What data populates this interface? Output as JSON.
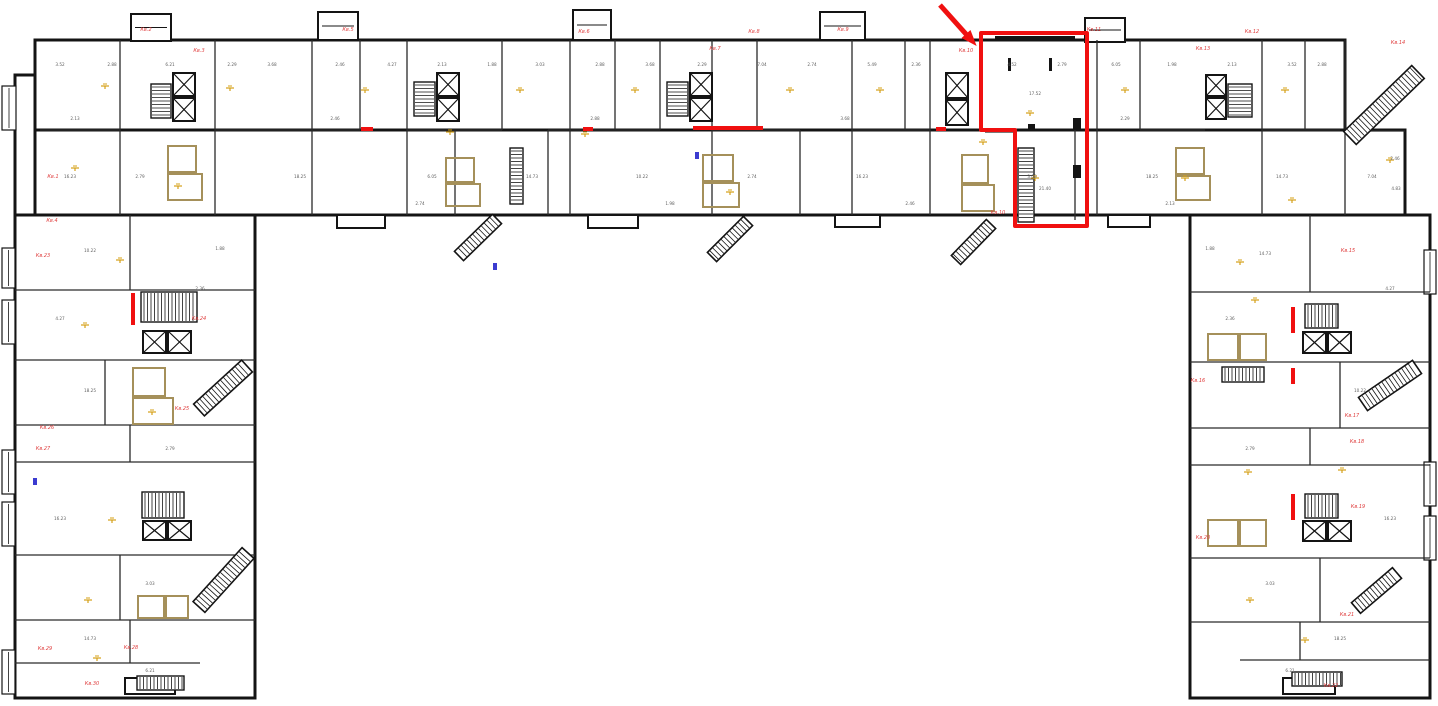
{
  "meta": {
    "drawing_type": "apartment-building-floor-plan",
    "canvas": {
      "w": 1438,
      "h": 706
    },
    "colors": {
      "wall": "#141414",
      "partition": "#2a2a2a",
      "wet_wall": "#a5905a",
      "light_symbol": "#d4a017",
      "dimension_text": "#5f5f5f",
      "apartment_label": "#e04040",
      "highlight": "#f01010",
      "blue_mark": "#3b3bd0",
      "background": "#ffffff"
    }
  },
  "plan": {
    "outer": [
      [
        15,
        75,
        105,
        140
      ],
      [
        35,
        40,
        1310,
        95
      ],
      [
        35,
        130,
        1370,
        85
      ],
      [
        15,
        215,
        240,
        483
      ],
      [
        1190,
        215,
        240,
        483
      ]
    ],
    "towers": [
      [
        131,
        14,
        40,
        27
      ],
      [
        318,
        12,
        40,
        28
      ],
      [
        573,
        10,
        38,
        30
      ],
      [
        820,
        12,
        45,
        28
      ],
      [
        1085,
        18,
        40,
        24
      ]
    ],
    "edge_balconies": [
      [
        2,
        86,
        14,
        44
      ],
      [
        2,
        248,
        13,
        40
      ],
      [
        2,
        300,
        13,
        44
      ],
      [
        2,
        450,
        13,
        44
      ],
      [
        2,
        502,
        13,
        44
      ],
      [
        2,
        650,
        13,
        44
      ],
      [
        1424,
        250,
        12,
        44
      ],
      [
        1424,
        462,
        12,
        44
      ],
      [
        1424,
        516,
        12,
        44
      ]
    ],
    "elevators": [
      [
        173,
        73,
        22,
        23
      ],
      [
        173,
        98,
        22,
        23
      ],
      [
        437,
        73,
        22,
        23
      ],
      [
        437,
        98,
        22,
        23
      ],
      [
        690,
        73,
        22,
        23
      ],
      [
        690,
        98,
        22,
        23
      ],
      [
        946,
        73,
        22,
        25
      ],
      [
        946,
        100,
        22,
        25
      ],
      [
        1206,
        75,
        20,
        21
      ],
      [
        1206,
        98,
        20,
        21
      ],
      [
        143,
        331,
        23,
        22
      ],
      [
        168,
        331,
        23,
        22
      ],
      [
        143,
        521,
        23,
        19
      ],
      [
        168,
        521,
        23,
        19
      ],
      [
        1303,
        332,
        23,
        21
      ],
      [
        1328,
        332,
        23,
        21
      ],
      [
        1303,
        521,
        23,
        20
      ],
      [
        1328,
        521,
        23,
        20
      ]
    ],
    "stairs": [
      [
        151,
        84,
        20,
        34,
        "h"
      ],
      [
        414,
        82,
        21,
        34,
        "h"
      ],
      [
        667,
        82,
        21,
        34,
        "h"
      ],
      [
        1018,
        148,
        16,
        74,
        "h"
      ],
      [
        1228,
        84,
        24,
        33,
        "h"
      ],
      [
        510,
        148,
        13,
        56,
        "h"
      ],
      [
        141,
        292,
        56,
        30,
        "v"
      ],
      [
        142,
        492,
        42,
        26,
        "v"
      ],
      [
        1305,
        304,
        33,
        24,
        "v"
      ],
      [
        1222,
        367,
        42,
        15,
        "v"
      ],
      [
        1305,
        494,
        33,
        24,
        "v"
      ],
      [
        137,
        676,
        47,
        14,
        "v"
      ],
      [
        1292,
        672,
        50,
        14,
        "v"
      ]
    ],
    "diag_balconies": [
      [
        1350,
        138,
        1418,
        72,
        18
      ],
      [
        199,
        410,
        247,
        366,
        16
      ],
      [
        199,
        607,
        248,
        553,
        16
      ],
      [
        1363,
        404,
        1417,
        367,
        16
      ],
      [
        1356,
        608,
        1397,
        573,
        14
      ],
      [
        497,
        219,
        459,
        256,
        13
      ],
      [
        748,
        221,
        712,
        257,
        13
      ],
      [
        991,
        224,
        956,
        260,
        13
      ]
    ],
    "bay_bumps": [
      [
        337,
        215,
        48,
        13
      ],
      [
        588,
        215,
        50,
        13
      ],
      [
        835,
        215,
        45,
        12
      ],
      [
        1108,
        215,
        42,
        12
      ],
      [
        125,
        678,
        50,
        16
      ],
      [
        1283,
        678,
        52,
        16
      ]
    ],
    "part_v": [
      [
        120,
        40,
        215
      ],
      [
        215,
        40,
        215
      ],
      [
        312,
        40,
        215
      ],
      [
        360,
        40,
        130
      ],
      [
        407,
        40,
        215
      ],
      [
        455,
        130,
        215
      ],
      [
        502,
        40,
        130
      ],
      [
        548,
        130,
        215
      ],
      [
        570,
        40,
        215
      ],
      [
        615,
        40,
        130
      ],
      [
        660,
        40,
        130
      ],
      [
        712,
        40,
        215
      ],
      [
        757,
        40,
        130
      ],
      [
        800,
        130,
        215
      ],
      [
        852,
        40,
        215
      ],
      [
        905,
        40,
        130
      ],
      [
        930,
        40,
        215
      ],
      [
        1075,
        120,
        220
      ],
      [
        1097,
        40,
        215
      ],
      [
        1140,
        40,
        130
      ],
      [
        1262,
        40,
        215
      ],
      [
        1305,
        40,
        130
      ],
      [
        1345,
        40,
        215
      ],
      [
        130,
        215,
        290
      ],
      [
        105,
        360,
        425
      ],
      [
        130,
        425,
        462
      ],
      [
        120,
        555,
        620
      ],
      [
        130,
        620,
        663
      ],
      [
        1310,
        215,
        292
      ],
      [
        1340,
        362,
        428
      ],
      [
        1310,
        428,
        465
      ],
      [
        1320,
        558,
        622
      ],
      [
        1300,
        622,
        660
      ]
    ],
    "part_h": [
      [
        130,
        40,
        120
      ],
      [
        130,
        215,
        360
      ],
      [
        130,
        407,
        502
      ],
      [
        130,
        548,
        660
      ],
      [
        130,
        712,
        800
      ],
      [
        130,
        852,
        930
      ],
      [
        132,
        985,
        1015
      ],
      [
        130,
        1140,
        1205
      ],
      [
        130,
        1262,
        1340
      ],
      [
        131,
        1345,
        1405
      ],
      [
        290,
        15,
        255
      ],
      [
        360,
        15,
        255
      ],
      [
        425,
        15,
        255
      ],
      [
        462,
        15,
        255
      ],
      [
        555,
        15,
        255
      ],
      [
        620,
        15,
        255
      ],
      [
        663,
        15,
        200
      ],
      [
        292,
        1190,
        1430
      ],
      [
        362,
        1190,
        1430
      ],
      [
        428,
        1190,
        1430
      ],
      [
        465,
        1190,
        1430
      ],
      [
        558,
        1190,
        1430
      ],
      [
        622,
        1190,
        1430
      ],
      [
        660,
        1240,
        1430
      ]
    ],
    "wet_walls": [
      [
        168,
        146,
        28,
        26
      ],
      [
        168,
        174,
        34,
        26
      ],
      [
        446,
        158,
        28,
        24
      ],
      [
        446,
        184,
        34,
        22
      ],
      [
        703,
        155,
        30,
        26
      ],
      [
        703,
        183,
        36,
        24
      ],
      [
        962,
        155,
        26,
        28
      ],
      [
        962,
        185,
        32,
        26
      ],
      [
        1176,
        148,
        28,
        26
      ],
      [
        1176,
        176,
        34,
        24
      ],
      [
        133,
        368,
        32,
        28
      ],
      [
        133,
        398,
        40,
        26
      ],
      [
        138,
        596,
        26,
        22
      ],
      [
        166,
        596,
        22,
        22
      ],
      [
        1208,
        334,
        30,
        26
      ],
      [
        1240,
        334,
        26,
        26
      ],
      [
        1208,
        520,
        30,
        26
      ],
      [
        1240,
        520,
        26,
        26
      ]
    ],
    "red_walls": [
      [
        693,
        126,
        70,
        4
      ],
      [
        131,
        293,
        4,
        32
      ],
      [
        1291,
        307,
        4,
        26
      ],
      [
        1291,
        368,
        4,
        16
      ],
      [
        1291,
        494,
        4,
        26
      ],
      [
        361,
        127,
        12,
        4
      ],
      [
        936,
        127,
        10,
        4
      ],
      [
        583,
        127,
        10,
        4
      ]
    ],
    "unit_details": [
      [
        995,
        36,
        80,
        5
      ],
      [
        1008,
        58,
        3,
        13
      ],
      [
        1049,
        58,
        3,
        13
      ],
      [
        1028,
        124,
        7,
        7
      ],
      [
        1073,
        118,
        8,
        12
      ],
      [
        1073,
        165,
        8,
        13
      ]
    ],
    "lights": [
      [
        105,
        86
      ],
      [
        230,
        88
      ],
      [
        75,
        168
      ],
      [
        178,
        186
      ],
      [
        365,
        90
      ],
      [
        450,
        132
      ],
      [
        520,
        90
      ],
      [
        635,
        90
      ],
      [
        585,
        134
      ],
      [
        730,
        192
      ],
      [
        790,
        90
      ],
      [
        880,
        90
      ],
      [
        1030,
        113
      ],
      [
        983,
        142
      ],
      [
        1035,
        178
      ],
      [
        1125,
        90
      ],
      [
        1185,
        178
      ],
      [
        1285,
        90
      ],
      [
        1292,
        200
      ],
      [
        1390,
        160
      ],
      [
        120,
        260
      ],
      [
        85,
        325
      ],
      [
        152,
        412
      ],
      [
        112,
        520
      ],
      [
        88,
        600
      ],
      [
        97,
        658
      ],
      [
        1240,
        262
      ],
      [
        1255,
        300
      ],
      [
        1248,
        472
      ],
      [
        1342,
        470
      ],
      [
        1250,
        600
      ],
      [
        1305,
        640
      ]
    ],
    "blue_marks": [
      [
        695,
        152
      ],
      [
        33,
        478
      ],
      [
        493,
        263
      ]
    ],
    "dims": [
      [
        60,
        66,
        "3.52"
      ],
      [
        112,
        66,
        "2.88"
      ],
      [
        170,
        66,
        "6.21"
      ],
      [
        232,
        66,
        "2.29"
      ],
      [
        272,
        66,
        "3.68"
      ],
      [
        340,
        66,
        "2.46"
      ],
      [
        392,
        66,
        "4.27"
      ],
      [
        442,
        66,
        "2.13"
      ],
      [
        492,
        66,
        "1.88"
      ],
      [
        540,
        66,
        "3.03"
      ],
      [
        600,
        66,
        "2.88"
      ],
      [
        650,
        66,
        "3.68"
      ],
      [
        702,
        66,
        "2.29"
      ],
      [
        762,
        66,
        "7.04"
      ],
      [
        812,
        66,
        "2.74"
      ],
      [
        872,
        66,
        "5.49"
      ],
      [
        916,
        66,
        "2.36"
      ],
      [
        1012,
        66,
        "4.52"
      ],
      [
        1062,
        66,
        "2.79"
      ],
      [
        1116,
        66,
        "6.05"
      ],
      [
        1172,
        66,
        "1.98"
      ],
      [
        1232,
        66,
        "2.13"
      ],
      [
        1292,
        66,
        "3.52"
      ],
      [
        1322,
        66,
        "2.88"
      ],
      [
        70,
        178,
        "16.23"
      ],
      [
        140,
        178,
        "2.79"
      ],
      [
        300,
        178,
        "18.25"
      ],
      [
        432,
        178,
        "6.05"
      ],
      [
        532,
        178,
        "14.73"
      ],
      [
        642,
        178,
        "10.22"
      ],
      [
        752,
        178,
        "2.74"
      ],
      [
        862,
        178,
        "16.23"
      ],
      [
        1032,
        178,
        "3.03"
      ],
      [
        1152,
        178,
        "18.25"
      ],
      [
        1282,
        178,
        "14.73"
      ],
      [
        1372,
        178,
        "7.04"
      ],
      [
        1396,
        190,
        "4.83"
      ],
      [
        1395,
        160,
        "2.46"
      ],
      [
        75,
        120,
        "2.13"
      ],
      [
        335,
        120,
        "2.46"
      ],
      [
        595,
        120,
        "2.88"
      ],
      [
        845,
        120,
        "3.68"
      ],
      [
        1125,
        120,
        "2.29"
      ],
      [
        90,
        252,
        "10.22"
      ],
      [
        220,
        250,
        "1.88"
      ],
      [
        60,
        320,
        "4.27"
      ],
      [
        200,
        290,
        "2.36"
      ],
      [
        90,
        392,
        "18.25"
      ],
      [
        170,
        450,
        "2.79"
      ],
      [
        60,
        520,
        "16.23"
      ],
      [
        150,
        585,
        "3.03"
      ],
      [
        90,
        640,
        "14.73"
      ],
      [
        150,
        672,
        "6.21"
      ],
      [
        1265,
        255,
        "14.73"
      ],
      [
        1210,
        250,
        "1.88"
      ],
      [
        1390,
        290,
        "4.27"
      ],
      [
        1230,
        320,
        "2.36"
      ],
      [
        1360,
        392,
        "10.22"
      ],
      [
        1250,
        450,
        "2.79"
      ],
      [
        1390,
        520,
        "16.23"
      ],
      [
        1270,
        585,
        "3.03"
      ],
      [
        1340,
        640,
        "18.25"
      ],
      [
        1290,
        672,
        "6.21"
      ],
      [
        420,
        205,
        "2.74"
      ],
      [
        670,
        205,
        "1.98"
      ],
      [
        910,
        205,
        "2.46"
      ],
      [
        1170,
        205,
        "2.13"
      ],
      [
        1035,
        95,
        "17.52"
      ],
      [
        1045,
        190,
        "21.40"
      ]
    ],
    "apartment_labels": [
      [
        53,
        178,
        "Кв.1"
      ],
      [
        146,
        31,
        "Кв.2"
      ],
      [
        199,
        52,
        "Кв.3"
      ],
      [
        52,
        222,
        "Кв.4"
      ],
      [
        348,
        31,
        "Кв.5"
      ],
      [
        584,
        33,
        "Кв.6"
      ],
      [
        715,
        50,
        "Кв.7"
      ],
      [
        754,
        33,
        "Кв.8"
      ],
      [
        843,
        31,
        "Кв.9"
      ],
      [
        966,
        52,
        "Кв.10"
      ],
      [
        998,
        214,
        "Кв.10"
      ],
      [
        1094,
        31,
        "Кв.11"
      ],
      [
        1252,
        33,
        "Кв.12"
      ],
      [
        1203,
        50,
        "Кв.13"
      ],
      [
        1398,
        44,
        "Кв.14"
      ],
      [
        1348,
        252,
        "Кв.15"
      ],
      [
        1198,
        382,
        "Кв.16"
      ],
      [
        1352,
        417,
        "Кв.17"
      ],
      [
        1357,
        443,
        "Кв.18"
      ],
      [
        1358,
        508,
        "Кв.19"
      ],
      [
        1203,
        539,
        "Кв.20"
      ],
      [
        1347,
        616,
        "Кв.21"
      ],
      [
        1331,
        687,
        "Кв.22"
      ],
      [
        43,
        257,
        "Кв.23"
      ],
      [
        199,
        320,
        "Кв.24"
      ],
      [
        182,
        410,
        "Кв.25"
      ],
      [
        47,
        429,
        "Кв.26"
      ],
      [
        43,
        450,
        "Кв.27"
      ],
      [
        131,
        649,
        "Кв.28"
      ],
      [
        45,
        650,
        "Кв.29"
      ],
      [
        92,
        685,
        "Кв.30"
      ]
    ],
    "highlight": {
      "points": "981,33 1087,33 1087,226 1015,226 1015,130 981,130",
      "stroke_width": 4
    },
    "arrow": {
      "x1": 940,
      "y1": 5,
      "x2": 974,
      "y2": 43
    }
  }
}
